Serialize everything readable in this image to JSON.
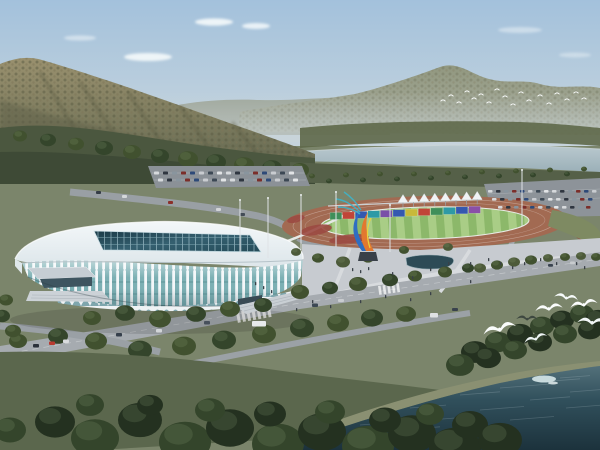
{
  "scene": {
    "description": "Aerial architectural rendering of a white lattice-facade stadium and sports park with running track, plaza sculpture, tents, parking, forested mountains, a river band and dark water in the foreground with seagulls",
    "time_of_day": "daytime"
  },
  "palette": {
    "sky_top": "#a3c1dc",
    "sky_mid": "#bccfdd",
    "sky_horizon": "#ccd6dc",
    "cloud": "#f5f9fb",
    "ridge": "#949a86",
    "ridge_far": "#a8ae9f",
    "mountain_hi": "#99906e",
    "mountain_lo": "#666a52",
    "mountain_shadow": "#565a42",
    "treeband": "#4b573f",
    "treeband_dark": "#3e4a36",
    "river": "#aec0c7",
    "ground": "#7b856b",
    "grass_dark": "#5b674d",
    "grass_mid": "#6c7759",
    "road": "#a6abb0",
    "road_minor": "#9aa0a5",
    "plaza": "#c7cbd0",
    "walk": "#d8dbde",
    "parking": "#8b9197",
    "track": "#a26a52",
    "infield_a": "#8cb86a",
    "infield_b": "#a9cd86",
    "flowerbed": "#9c4a42",
    "stadium_white": "#f1f5f7",
    "stadium_rib": "#f3f7f9",
    "glass": "#7cb0b4",
    "glass_dark": "#639a9e",
    "skylight_deep": "#16323e",
    "skylight_lite": "#2f5867",
    "arch_teal": "#7fa6ad",
    "tent": "#f0f3f5",
    "sculpture_blue": "#2e6ec2",
    "sculpture_orange": "#e2782f",
    "sculpture_yellow": "#ead23e",
    "sculpture_teal": "#3fb3c9",
    "water_top": "#53707a",
    "water_deep": "#1c323c",
    "water_sparkle": "#dfeef0",
    "bird_white": "#fafcfc",
    "gull_dark": "#3e4840",
    "people": "#3a4148"
  },
  "tree_shades": [
    "#34452b",
    "#41512f",
    "#243120",
    "#4c5a39"
  ],
  "hoarding": {
    "x0": 330,
    "dx": 12.6,
    "count": 12,
    "h": 7,
    "y0": 212.5,
    "slope": -0.045,
    "colors": [
      "#3f8f5a",
      "#c04538",
      "#3458b0",
      "#2e9aa6",
      "#7a4fa8",
      "#3458b0",
      "#c8b93a",
      "#c04538",
      "#3f8f5a",
      "#2e9aa6",
      "#3458b0",
      "#8a4fa8"
    ]
  },
  "tents": {
    "count": 8,
    "x0": 403,
    "dx": 10.6,
    "y0": 202.5,
    "dy": -0.45,
    "w": 10,
    "h": 8
  },
  "car_rows": [
    {
      "x0": 154,
      "y": 171.5,
      "dx": 9,
      "count": 16,
      "w": 5,
      "h": 3,
      "group": "parking-top-cars"
    },
    {
      "x0": 158,
      "y": 178.5,
      "dx": 9,
      "count": 16,
      "w": 5,
      "h": 3,
      "group": "parking-top-cars"
    },
    {
      "x0": 488,
      "y": 190,
      "dx": 8,
      "count": 14,
      "w": 4.5,
      "h": 2.6,
      "group": "parking-right-cars"
    },
    {
      "x0": 492,
      "y": 198,
      "dx": 8,
      "count": 13,
      "w": 4.5,
      "h": 2.6,
      "group": "parking-right-cars"
    },
    {
      "x0": 498,
      "y": 206,
      "dx": 8,
      "count": 12,
      "w": 4.5,
      "h": 2.6,
      "group": "parking-right-cars"
    }
  ],
  "car_colors": [
    "#d6d9dc",
    "#2f3640",
    "#89959e",
    "#7b2e2a",
    "#2e4a78",
    "#c9ccd0",
    "#3c4854",
    "#e2e4e6"
  ],
  "cars_free": [
    [
      33,
      344,
      6,
      3.5,
      "#2b313a"
    ],
    [
      49,
      341.5,
      6,
      3.5,
      "#b83a30"
    ],
    [
      63,
      339.5,
      6,
      3.5,
      "#d9dbde"
    ],
    [
      116,
      333,
      6,
      3.5,
      "#353f4b"
    ],
    [
      156,
      329,
      6,
      3.5,
      "#d2d5d8"
    ],
    [
      204,
      321,
      6,
      3.5,
      "#47505c"
    ],
    [
      252,
      321,
      14,
      5.5,
      "#e8eaec"
    ],
    [
      312,
      303.5,
      6,
      3.5,
      "#3c4854"
    ],
    [
      338,
      299,
      6,
      3,
      "#c9cccf"
    ],
    [
      430,
      313,
      8,
      4.5,
      "#dfe1e3"
    ],
    [
      452,
      308,
      6,
      3,
      "#39424d"
    ],
    [
      96,
      191,
      5,
      3,
      "#343c46"
    ],
    [
      122,
      195,
      5,
      3,
      "#d5d8da"
    ],
    [
      168,
      201,
      5,
      3,
      "#8c2f2a"
    ],
    [
      6,
      369,
      6,
      3.5,
      "#dcdee0"
    ],
    [
      548,
      264,
      5,
      2.8,
      "#3a4450"
    ],
    [
      570,
      261.5,
      5,
      2.8,
      "#c8cbce"
    ],
    [
      216,
      208,
      5,
      3,
      "#d2d4d7"
    ],
    [
      240,
      213,
      5,
      3,
      "#434c57"
    ]
  ],
  "people": [
    [
      352,
      268
    ],
    [
      360,
      270
    ],
    [
      368,
      267
    ],
    [
      392,
      272
    ],
    [
      412,
      276
    ],
    [
      430,
      268
    ],
    [
      448,
      262
    ],
    [
      470,
      262
    ],
    [
      488,
      258
    ],
    [
      500,
      262
    ],
    [
      512,
      266
    ],
    [
      524,
      262
    ],
    [
      540,
      258
    ],
    [
      556,
      262
    ],
    [
      470,
      280
    ],
    [
      430,
      292
    ],
    [
      410,
      298
    ],
    [
      385,
      295
    ],
    [
      360,
      300
    ],
    [
      330,
      305
    ],
    [
      576,
      262
    ],
    [
      584,
      266
    ],
    [
      312,
      300
    ],
    [
      296,
      308
    ],
    [
      255,
      282
    ],
    [
      263,
      286
    ],
    [
      271,
      290
    ]
  ],
  "poles": [
    [
      268,
      198,
      258
    ],
    [
      301,
      195,
      250
    ],
    [
      336,
      192,
      247
    ],
    [
      390,
      205,
      252
    ],
    [
      522,
      170,
      226
    ],
    [
      240,
      200,
      252
    ]
  ],
  "bird_flock": [
    [
      443,
      101
    ],
    [
      451,
      96
    ],
    [
      459,
      103
    ],
    [
      467,
      92
    ],
    [
      474,
      99
    ],
    [
      481,
      95
    ],
    [
      489,
      103
    ],
    [
      497,
      90
    ],
    [
      505,
      97
    ],
    [
      513,
      105
    ],
    [
      521,
      93
    ],
    [
      529,
      101
    ],
    [
      540,
      96
    ],
    [
      549,
      104
    ],
    [
      557,
      94
    ],
    [
      567,
      100
    ],
    [
      576,
      93
    ],
    [
      584,
      99
    ]
  ],
  "seagulls": [
    [
      500,
      331,
      1.4,
      -12,
      "#fafcfc"
    ],
    [
      527,
      320,
      0.9,
      5,
      "#3e4840"
    ],
    [
      549,
      310,
      1.15,
      -5,
      "#fafcfc"
    ],
    [
      566,
      299,
      1.0,
      12,
      "#f6fafa"
    ],
    [
      584,
      306,
      1.15,
      -8,
      "#fafcfc"
    ],
    [
      592,
      324,
      1.25,
      6,
      "#f2f7f7"
    ],
    [
      536,
      340,
      1.0,
      -15,
      "#eef4f4"
    ]
  ],
  "ripples": [
    [
      320,
      438,
      30
    ],
    [
      360,
      425,
      40
    ],
    [
      410,
      408,
      36
    ],
    [
      460,
      395,
      40
    ],
    [
      500,
      388,
      50
    ],
    [
      540,
      382,
      40
    ],
    [
      430,
      420,
      50
    ],
    [
      480,
      410,
      44
    ],
    [
      530,
      400,
      40
    ],
    [
      570,
      392,
      36
    ],
    [
      350,
      440,
      44
    ],
    [
      400,
      430,
      40
    ],
    [
      560,
      378,
      30
    ],
    [
      450,
      435,
      40
    ],
    [
      510,
      420,
      44
    ],
    [
      566,
      408,
      40
    ]
  ],
  "trees": {
    "boulevard-trees": [
      [
        300,
        292,
        9,
        1
      ],
      [
        330,
        288,
        8,
        0
      ],
      [
        358,
        284,
        9,
        1
      ],
      [
        390,
        280,
        8,
        0
      ],
      [
        415,
        276,
        7,
        1
      ],
      [
        92,
        318,
        9,
        1
      ],
      [
        125,
        313,
        10,
        0
      ],
      [
        160,
        319,
        11,
        1
      ],
      [
        196,
        314,
        10,
        0
      ],
      [
        230,
        309,
        10,
        1
      ],
      [
        263,
        305,
        9,
        0
      ],
      [
        445,
        272,
        7,
        1
      ],
      [
        468,
        268,
        6,
        0
      ]
    ],
    "roadside-trees": [
      [
        18,
        341,
        9,
        1
      ],
      [
        58,
        336,
        10,
        0
      ],
      [
        96,
        341,
        11,
        1
      ],
      [
        140,
        350,
        12,
        0
      ],
      [
        184,
        346,
        12,
        1
      ],
      [
        224,
        340,
        12,
        0
      ],
      [
        264,
        334,
        12,
        1
      ],
      [
        302,
        328,
        12,
        0
      ],
      [
        338,
        323,
        11,
        1
      ],
      [
        372,
        318,
        11,
        0
      ],
      [
        406,
        314,
        10,
        1
      ]
    ],
    "plaza-row-trees": [
      [
        480,
        268,
        6,
        3
      ],
      [
        497,
        265,
        6,
        1
      ],
      [
        514,
        262,
        6,
        3
      ],
      [
        531,
        260,
        6,
        1
      ],
      [
        548,
        258,
        5,
        3
      ],
      [
        565,
        257,
        5,
        1
      ],
      [
        581,
        256,
        5,
        3
      ],
      [
        596,
        257,
        5,
        1
      ]
    ],
    "plaza-scatter-trees": [
      [
        318,
        258,
        6,
        1
      ],
      [
        343,
        262,
        7,
        3
      ],
      [
        368,
        258,
        6,
        1
      ],
      [
        296,
        252,
        5,
        3
      ],
      [
        404,
        250,
        5,
        1
      ],
      [
        448,
        247,
        5,
        3
      ]
    ],
    "stadium-left-trees": [
      [
        6,
        300,
        7,
        1
      ],
      [
        2,
        316,
        8,
        0
      ],
      [
        13,
        331,
        8,
        1
      ]
    ],
    "riverbank-trees": [
      [
        312,
        176,
        3,
        1
      ],
      [
        329,
        181,
        3,
        0
      ],
      [
        346,
        175,
        3,
        1
      ],
      [
        363,
        180,
        3,
        0
      ],
      [
        380,
        174,
        3,
        1
      ],
      [
        397,
        179,
        3,
        0
      ],
      [
        414,
        174,
        3,
        1
      ],
      [
        431,
        178,
        3,
        0
      ],
      [
        448,
        173,
        3,
        1
      ],
      [
        465,
        177,
        3,
        0
      ],
      [
        482,
        172,
        3,
        1
      ],
      [
        499,
        176,
        3,
        0
      ],
      [
        516,
        171,
        3,
        1
      ],
      [
        533,
        175,
        3,
        0
      ],
      [
        550,
        170,
        3,
        1
      ],
      [
        567,
        174,
        3,
        0
      ],
      [
        584,
        169,
        3,
        1
      ]
    ],
    "mountain-base-trees": [
      [
        20,
        136,
        7,
        1
      ],
      [
        48,
        140,
        8,
        0
      ],
      [
        76,
        144,
        8,
        1
      ],
      [
        104,
        148,
        9,
        0
      ],
      [
        132,
        152,
        9,
        1
      ],
      [
        160,
        156,
        9,
        0
      ],
      [
        188,
        159,
        10,
        1
      ],
      [
        216,
        162,
        10,
        0
      ],
      [
        244,
        165,
        10,
        1
      ],
      [
        272,
        168,
        10,
        0
      ],
      [
        300,
        170,
        9,
        1
      ]
    ],
    "foreground-trees": [
      [
        55,
        422,
        20,
        2
      ],
      [
        95,
        438,
        24,
        0
      ],
      [
        140,
        420,
        22,
        2
      ],
      [
        185,
        442,
        26,
        0
      ],
      [
        230,
        428,
        24,
        2
      ],
      [
        278,
        444,
        26,
        0
      ],
      [
        322,
        432,
        24,
        2
      ],
      [
        368,
        446,
        26,
        0
      ],
      [
        412,
        434,
        24,
        2
      ],
      [
        455,
        448,
        26,
        2
      ],
      [
        90,
        405,
        14,
        0
      ],
      [
        150,
        405,
        13,
        2
      ],
      [
        210,
        410,
        15,
        0
      ],
      [
        270,
        414,
        16,
        2
      ],
      [
        330,
        412,
        15,
        0
      ],
      [
        385,
        420,
        16,
        2
      ],
      [
        430,
        414,
        14,
        0
      ],
      [
        470,
        425,
        18,
        2
      ],
      [
        500,
        440,
        22,
        2
      ],
      [
        10,
        430,
        16,
        0
      ]
    ],
    "right-bank-trees": [
      [
        475,
        352,
        14,
        2
      ],
      [
        498,
        342,
        13,
        0
      ],
      [
        520,
        334,
        13,
        2
      ],
      [
        542,
        326,
        12,
        0
      ],
      [
        562,
        320,
        12,
        2
      ],
      [
        582,
        314,
        12,
        0
      ],
      [
        598,
        320,
        13,
        2
      ],
      [
        460,
        365,
        14,
        0
      ],
      [
        488,
        358,
        13,
        2
      ],
      [
        515,
        350,
        12,
        0
      ],
      [
        540,
        342,
        12,
        2
      ],
      [
        565,
        334,
        12,
        0
      ],
      [
        590,
        330,
        12,
        2
      ]
    ]
  }
}
